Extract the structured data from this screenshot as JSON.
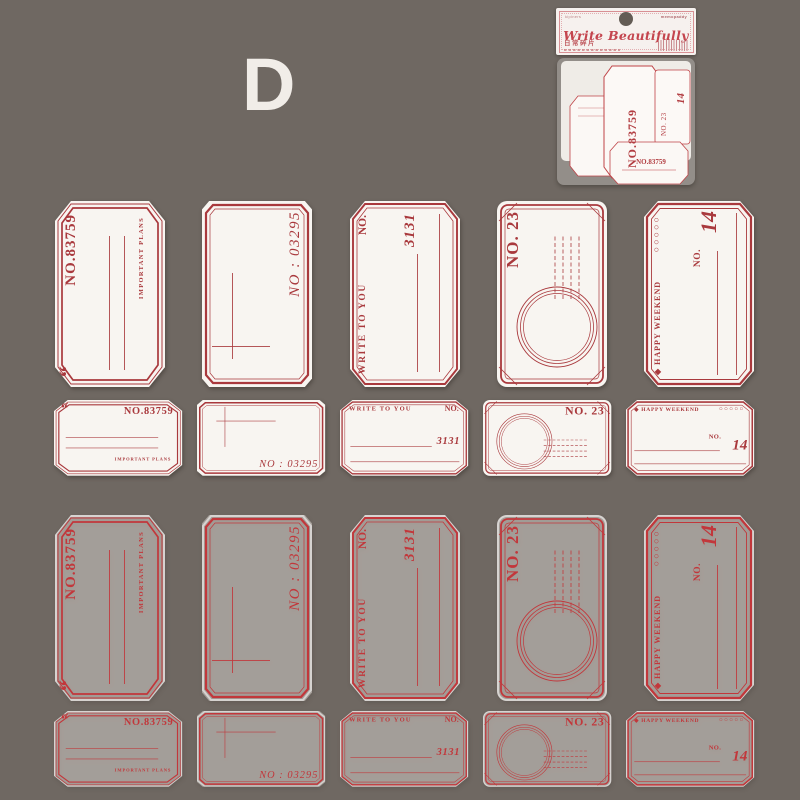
{
  "scene": {
    "background_color": "#6f6862",
    "variant_letter": "D"
  },
  "package": {
    "header": {
      "brand_left": "kipiners",
      "brand_right": "memopaddy",
      "title": "Write Beautifully",
      "subtitle_cn": "日常碎片"
    },
    "bag": {
      "texts": {
        "big_vertical": "NO.83759",
        "right_number": "14",
        "right_vertical": "NO. 23",
        "bottom": "NO.83759"
      }
    }
  },
  "labels": {
    "paper_color": "#f8f5f1",
    "ink_paper": "#a9393d",
    "ink_film": "#c2373b",
    "designs": [
      {
        "id": "important-plans",
        "quote": "“",
        "number": "NO.83759",
        "tagline": "IMPORTANT PLANS"
      },
      {
        "id": "no-03295",
        "number": "NO : 03295"
      },
      {
        "id": "write-to-you",
        "heading": "WRITE TO YOU",
        "no_label": "NO.",
        "number": "3131"
      },
      {
        "id": "no-23",
        "number": "NO. 23"
      },
      {
        "id": "happy-weekend",
        "heading": "◆ HAPPY WEEKEND",
        "circles": "○○○○○",
        "no_label": "NO.",
        "number": "14"
      }
    ],
    "rows": [
      {
        "id": "tall-paper",
        "material": "white paper",
        "size": "tall"
      },
      {
        "id": "small-paper",
        "material": "white paper",
        "size": "small"
      },
      {
        "id": "tall-film",
        "material": "translucent film",
        "size": "tall"
      },
      {
        "id": "small-film",
        "material": "translucent film",
        "size": "small"
      }
    ]
  }
}
